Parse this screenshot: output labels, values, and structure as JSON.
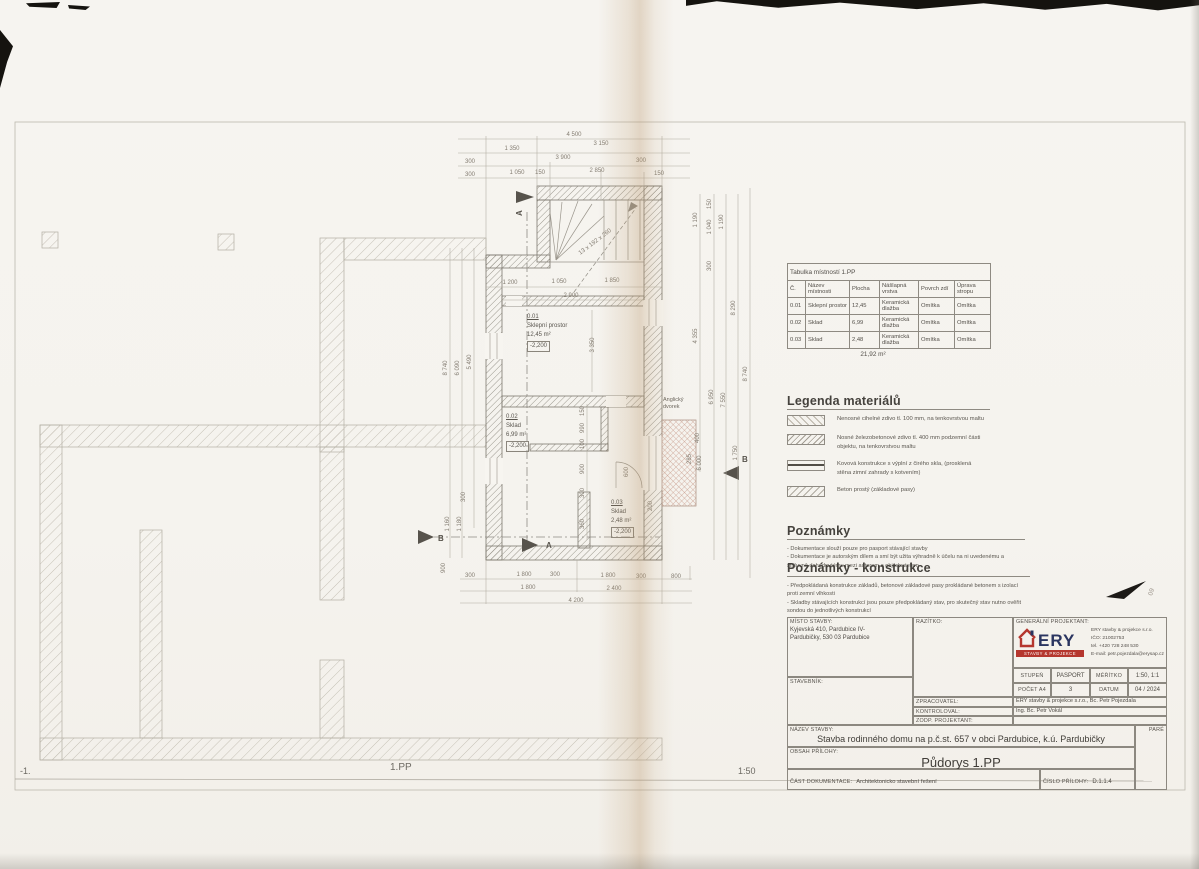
{
  "page": {
    "footer": {
      "left": "-1.",
      "center": "1.PP",
      "right": "1:50"
    }
  },
  "annotation": {
    "mark": "09"
  },
  "plan": {
    "rooms": [
      {
        "id": "0.01",
        "name": "Sklepní prostor",
        "area": "12,45 m²",
        "level": "-2,200"
      },
      {
        "id": "0.02",
        "name": "Sklad",
        "area": "6,99 m²",
        "level": "-2,200"
      },
      {
        "id": "0.03",
        "name": "Sklad",
        "area": "2,48 m²",
        "level": "-2,200"
      }
    ],
    "labels": {
      "courtyard1": "Anglický",
      "courtyard2": "dvorek",
      "stairs": "13 x 192 x 260",
      "section_a": "A",
      "section_b": "B"
    },
    "dimensions": [
      {
        "t": "4 500",
        "x": 574,
        "y": 136,
        "r": 0
      },
      {
        "t": "1 350",
        "x": 512,
        "y": 150,
        "r": 0
      },
      {
        "t": "3 150",
        "x": 601,
        "y": 145,
        "r": 0
      },
      {
        "t": "300",
        "x": 470,
        "y": 163,
        "r": 0
      },
      {
        "t": "3 900",
        "x": 563,
        "y": 159,
        "r": 0
      },
      {
        "t": "300",
        "x": 641,
        "y": 162,
        "r": 0
      },
      {
        "t": "300",
        "x": 470,
        "y": 176,
        "r": 0
      },
      {
        "t": "1 050",
        "x": 517,
        "y": 174,
        "r": 0
      },
      {
        "t": "150",
        "x": 540,
        "y": 174,
        "r": 0
      },
      {
        "t": "2 850",
        "x": 597,
        "y": 172,
        "r": 0
      },
      {
        "t": "150",
        "x": 659,
        "y": 175,
        "r": 0
      },
      {
        "t": "1 200",
        "x": 510,
        "y": 284,
        "r": 0
      },
      {
        "t": "1 050",
        "x": 559,
        "y": 283,
        "r": 0
      },
      {
        "t": "1 850",
        "x": 612,
        "y": 282,
        "r": 0
      },
      {
        "t": "2 900",
        "x": 571,
        "y": 297,
        "r": 0
      },
      {
        "t": "3 350",
        "x": 594,
        "y": 345,
        "r": -90
      },
      {
        "t": "8 740",
        "x": 447,
        "y": 368,
        "r": -90
      },
      {
        "t": "6 090",
        "x": 459,
        "y": 368,
        "r": -90
      },
      {
        "t": "5 490",
        "x": 471,
        "y": 362,
        "r": -90
      },
      {
        "t": "300",
        "x": 465,
        "y": 497,
        "r": -90
      },
      {
        "t": "1 160",
        "x": 449,
        "y": 524,
        "r": -90
      },
      {
        "t": "1 180",
        "x": 461,
        "y": 524,
        "r": -90
      },
      {
        "t": "900",
        "x": 445,
        "y": 568,
        "r": -90
      },
      {
        "t": "150",
        "x": 711,
        "y": 204,
        "r": -90
      },
      {
        "t": "1 190",
        "x": 697,
        "y": 220,
        "r": -90
      },
      {
        "t": "1 040",
        "x": 711,
        "y": 227,
        "r": -90
      },
      {
        "t": "1 190",
        "x": 723,
        "y": 222,
        "r": -90
      },
      {
        "t": "300",
        "x": 711,
        "y": 266,
        "r": -90
      },
      {
        "t": "8 290",
        "x": 735,
        "y": 308,
        "r": -90
      },
      {
        "t": "4 355",
        "x": 697,
        "y": 336,
        "r": -90
      },
      {
        "t": "8 740",
        "x": 747,
        "y": 374,
        "r": -90
      },
      {
        "t": "6 950",
        "x": 713,
        "y": 397,
        "r": -90
      },
      {
        "t": "7 550",
        "x": 725,
        "y": 400,
        "r": -90
      },
      {
        "t": "400",
        "x": 699,
        "y": 438,
        "r": -90
      },
      {
        "t": "285",
        "x": 691,
        "y": 459,
        "r": -90
      },
      {
        "t": "6 000",
        "x": 701,
        "y": 463,
        "r": -90
      },
      {
        "t": "1 750",
        "x": 737,
        "y": 453,
        "r": -90
      },
      {
        "t": "150",
        "x": 584,
        "y": 411,
        "r": -90
      },
      {
        "t": "990",
        "x": 584,
        "y": 428,
        "r": -90
      },
      {
        "t": "100",
        "x": 584,
        "y": 444,
        "r": -90
      },
      {
        "t": "900",
        "x": 584,
        "y": 469,
        "r": -90
      },
      {
        "t": "300",
        "x": 584,
        "y": 493,
        "r": -90
      },
      {
        "t": "360",
        "x": 584,
        "y": 524,
        "r": -90
      },
      {
        "t": "600",
        "x": 628,
        "y": 472,
        "r": -90
      },
      {
        "t": "200",
        "x": 652,
        "y": 506,
        "r": -90
      },
      {
        "t": "300",
        "x": 470,
        "y": 577,
        "r": 0
      },
      {
        "t": "1 800",
        "x": 524,
        "y": 576,
        "r": 0
      },
      {
        "t": "300",
        "x": 555,
        "y": 576,
        "r": 0
      },
      {
        "t": "1 800",
        "x": 608,
        "y": 577,
        "r": 0
      },
      {
        "t": "300",
        "x": 641,
        "y": 578,
        "r": 0
      },
      {
        "t": "800",
        "x": 676,
        "y": 578,
        "r": 0
      },
      {
        "t": "1 800",
        "x": 528,
        "y": 589,
        "r": 0
      },
      {
        "t": "2 400",
        "x": 614,
        "y": 590,
        "r": 0
      },
      {
        "t": "4 200",
        "x": 576,
        "y": 602,
        "r": 0
      }
    ]
  },
  "room_table": {
    "title": "Tabulka místností 1.PP",
    "headers": [
      "Č.",
      "Název místnosti",
      "Plocha",
      "Nášlapná vrstva",
      "Povrch zdí",
      "Úprava stropu"
    ],
    "rows": [
      [
        "0.01",
        "Sklepní prostor",
        "12,45",
        "Keramická dlažba",
        "Omítka",
        "Omítka"
      ],
      [
        "0.02",
        "Sklad",
        "6,99",
        "Keramická dlažba",
        "Omítka",
        "Omítka"
      ],
      [
        "0.03",
        "Sklad",
        "2,48",
        "Keramická dlažba",
        "Omítka",
        "Omítka"
      ]
    ],
    "total": "21,92 m²"
  },
  "legend": {
    "title": "Legenda materiálů",
    "items": [
      {
        "swatch": "sw-brick",
        "text": "Nenosné cihelné zdivo tl. 100 mm, na tenkovrstvou maltu"
      },
      {
        "swatch": "sw-diag",
        "text": "Nosné železobetonové zdivo tl. 400 mm podzemní části objektu, na tenkovrstvou maltu"
      },
      {
        "swatch": "sw-metal",
        "text": "Kovová konstrukce s výplní z čirého skla, (prosklená stěna zimní zahrady s kotvením)"
      },
      {
        "swatch": "sw-concrete",
        "text": "Beton prostý (základové pasy)"
      }
    ]
  },
  "notes": {
    "title": "Poznámky",
    "items": [
      "- Dokumentace slouží pouze pro pasport stávající stavby",
      "- Dokumentace je autorským dílem a smí být užita výhradně k účelu na ni uvedenému a smluvně dohodnutému mezi autorem a objednatelem"
    ]
  },
  "notes_construction": {
    "title": "Poznámky - konstrukce",
    "items": [
      "- Předpokládaná konstrukce základů, betonové základové pasy prokládané betonem s izolací proti zemní vlhkosti",
      "- Skladby stávajících konstrukcí jsou pouze předpokládaný stav, pro skutečný stav nutno ověřit sondou do jednotlivých konstrukcí"
    ]
  },
  "title_block": {
    "misto": {
      "label": "MÍSTO STAVBY:",
      "line1": "Kyjevská 410, Pardubice IV-",
      "line2": "Pardubičky, 530 03 Pardubice"
    },
    "stavebnik_label": "STAVEBNÍK:",
    "razitko_label": "RAZÍTKO:",
    "projektant": {
      "label": "GENERÁLNÍ PROJEKTANT:",
      "company": "ERY stavby & projekce s.r.o.",
      "ico": "IČO: 21002753",
      "tel": "tel. +420 728 248 530",
      "email": "E-mail: petr.pojezdala@erysap.cz",
      "logo_text": "ERY",
      "logo_sub": "STAVBY & PROJEKCE"
    },
    "grid": {
      "stupen_label": "STUPEŇ",
      "stupen": "PASPORT",
      "meritko_label": "MĚŘÍTKO",
      "meritko": "1:50, 1:1",
      "pocet_label": "POČET A4",
      "pocet": "3",
      "datum_label": "DATUM",
      "datum": "04 / 2024"
    },
    "zpracovatel": {
      "label": "ZPRACOVATEL:",
      "value": "ERY stavby & projekce s.r.o., Bc. Petr Pojezdala"
    },
    "kontroloval": {
      "label": "KONTROLOVAL:",
      "value": "Ing. Bc. Petr Vokál"
    },
    "zodp": {
      "label": "ZODP. PROJEKTANT:",
      "value": ""
    },
    "nazev": {
      "label": "NÁZEV STAVBY:",
      "value": "Stavba rodinného domu na p.č.st. 657 v obci Pardubice, k.ú. Pardubičky"
    },
    "obsah": {
      "label": "OBSAH PŘÍLOHY:",
      "value": "Půdorys 1.PP"
    },
    "cast": {
      "label": "ČÁST DOKUMENTACE:",
      "value": "Architektonicko stavební řešení"
    },
    "cislo": {
      "label": "ČÍSLO PŘÍLOHY:",
      "value": "D.1.1.4"
    },
    "pare_label": "PARÉ"
  }
}
